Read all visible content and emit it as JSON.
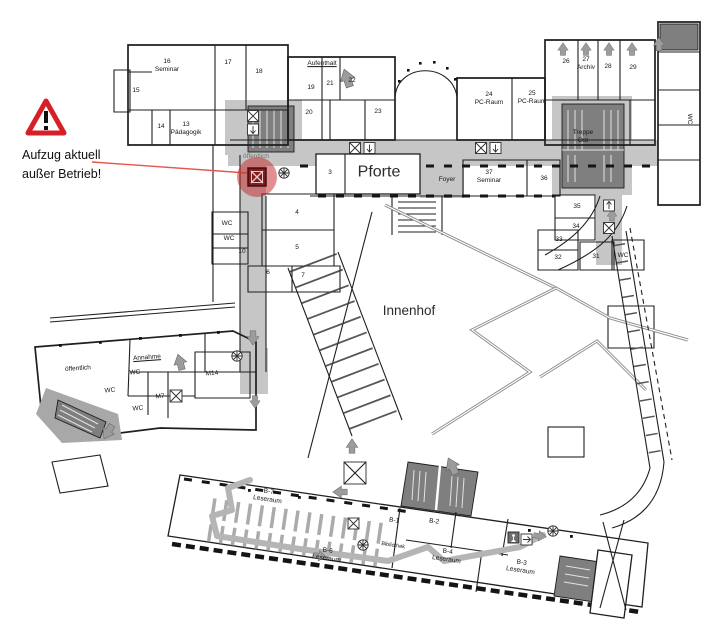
{
  "annotation": {
    "warning_text": "Aufzug aktuell\naußer Betrieb!",
    "warning_icon": "warning-triangle-icon",
    "colors": {
      "warning_red": "#d61f26",
      "highlight_red": "#c32b2b"
    }
  },
  "floorplan": {
    "labels": {
      "r15": "15",
      "r16": "16\nSeminar",
      "r17": "17",
      "r18": "18",
      "r14": "14",
      "r13": "13\nPädagogik",
      "aufenthalt": "Aufenthalt",
      "r19": "19",
      "r20": "20",
      "r21": "21",
      "r22": "22",
      "r23": "23",
      "r24": "24\nPC-Raum",
      "r25": "25\nPC-Raum",
      "r26": "26",
      "r27": "27\nArchiv",
      "r28": "28",
      "r29": "29",
      "treppe_ost": "Treppe\nOst",
      "oeffentlich_nord": "öffentlich",
      "r3": "3",
      "pforte": "Pforte",
      "foyer": "Foyer",
      "r37": "37\nSeminar",
      "r36": "36",
      "r35": "35",
      "r34": "34",
      "r33": "33",
      "r32": "32",
      "r31": "31",
      "wc_ost": "WC",
      "wc_fernost": "WC",
      "r4": "4",
      "r5": "5",
      "r6": "6",
      "r7": "7",
      "wc_west1": "WC",
      "wc_west2": "WC",
      "r10": "10",
      "innenhof": "Innenhof",
      "oeffentlich_sued": "öffentlich",
      "annahme": "Annahme",
      "wc_sw1": "WC",
      "wc_sw2": "WC",
      "wc_sw3": "WC",
      "m7": "M7",
      "m14": "M14",
      "b7": "B-7\nLeseraum",
      "b6": "B-6\nLeseraum",
      "b1": "B-1",
      "b2": "B-2",
      "bibliothek": "Bibliothek",
      "b4": "B-4\nLeseraum",
      "b3": "B-3\nLeseraum"
    },
    "icons": {
      "direction_arrow": "↑",
      "elevator": "⊠",
      "spiral_stairs": "✳",
      "stairs_core": "hatched block",
      "exit_person": "walking figure"
    },
    "colors": {
      "corridor": "#c6c6c6",
      "stair_core": "#7f7f7f",
      "walls": "#1f1f1f"
    }
  }
}
